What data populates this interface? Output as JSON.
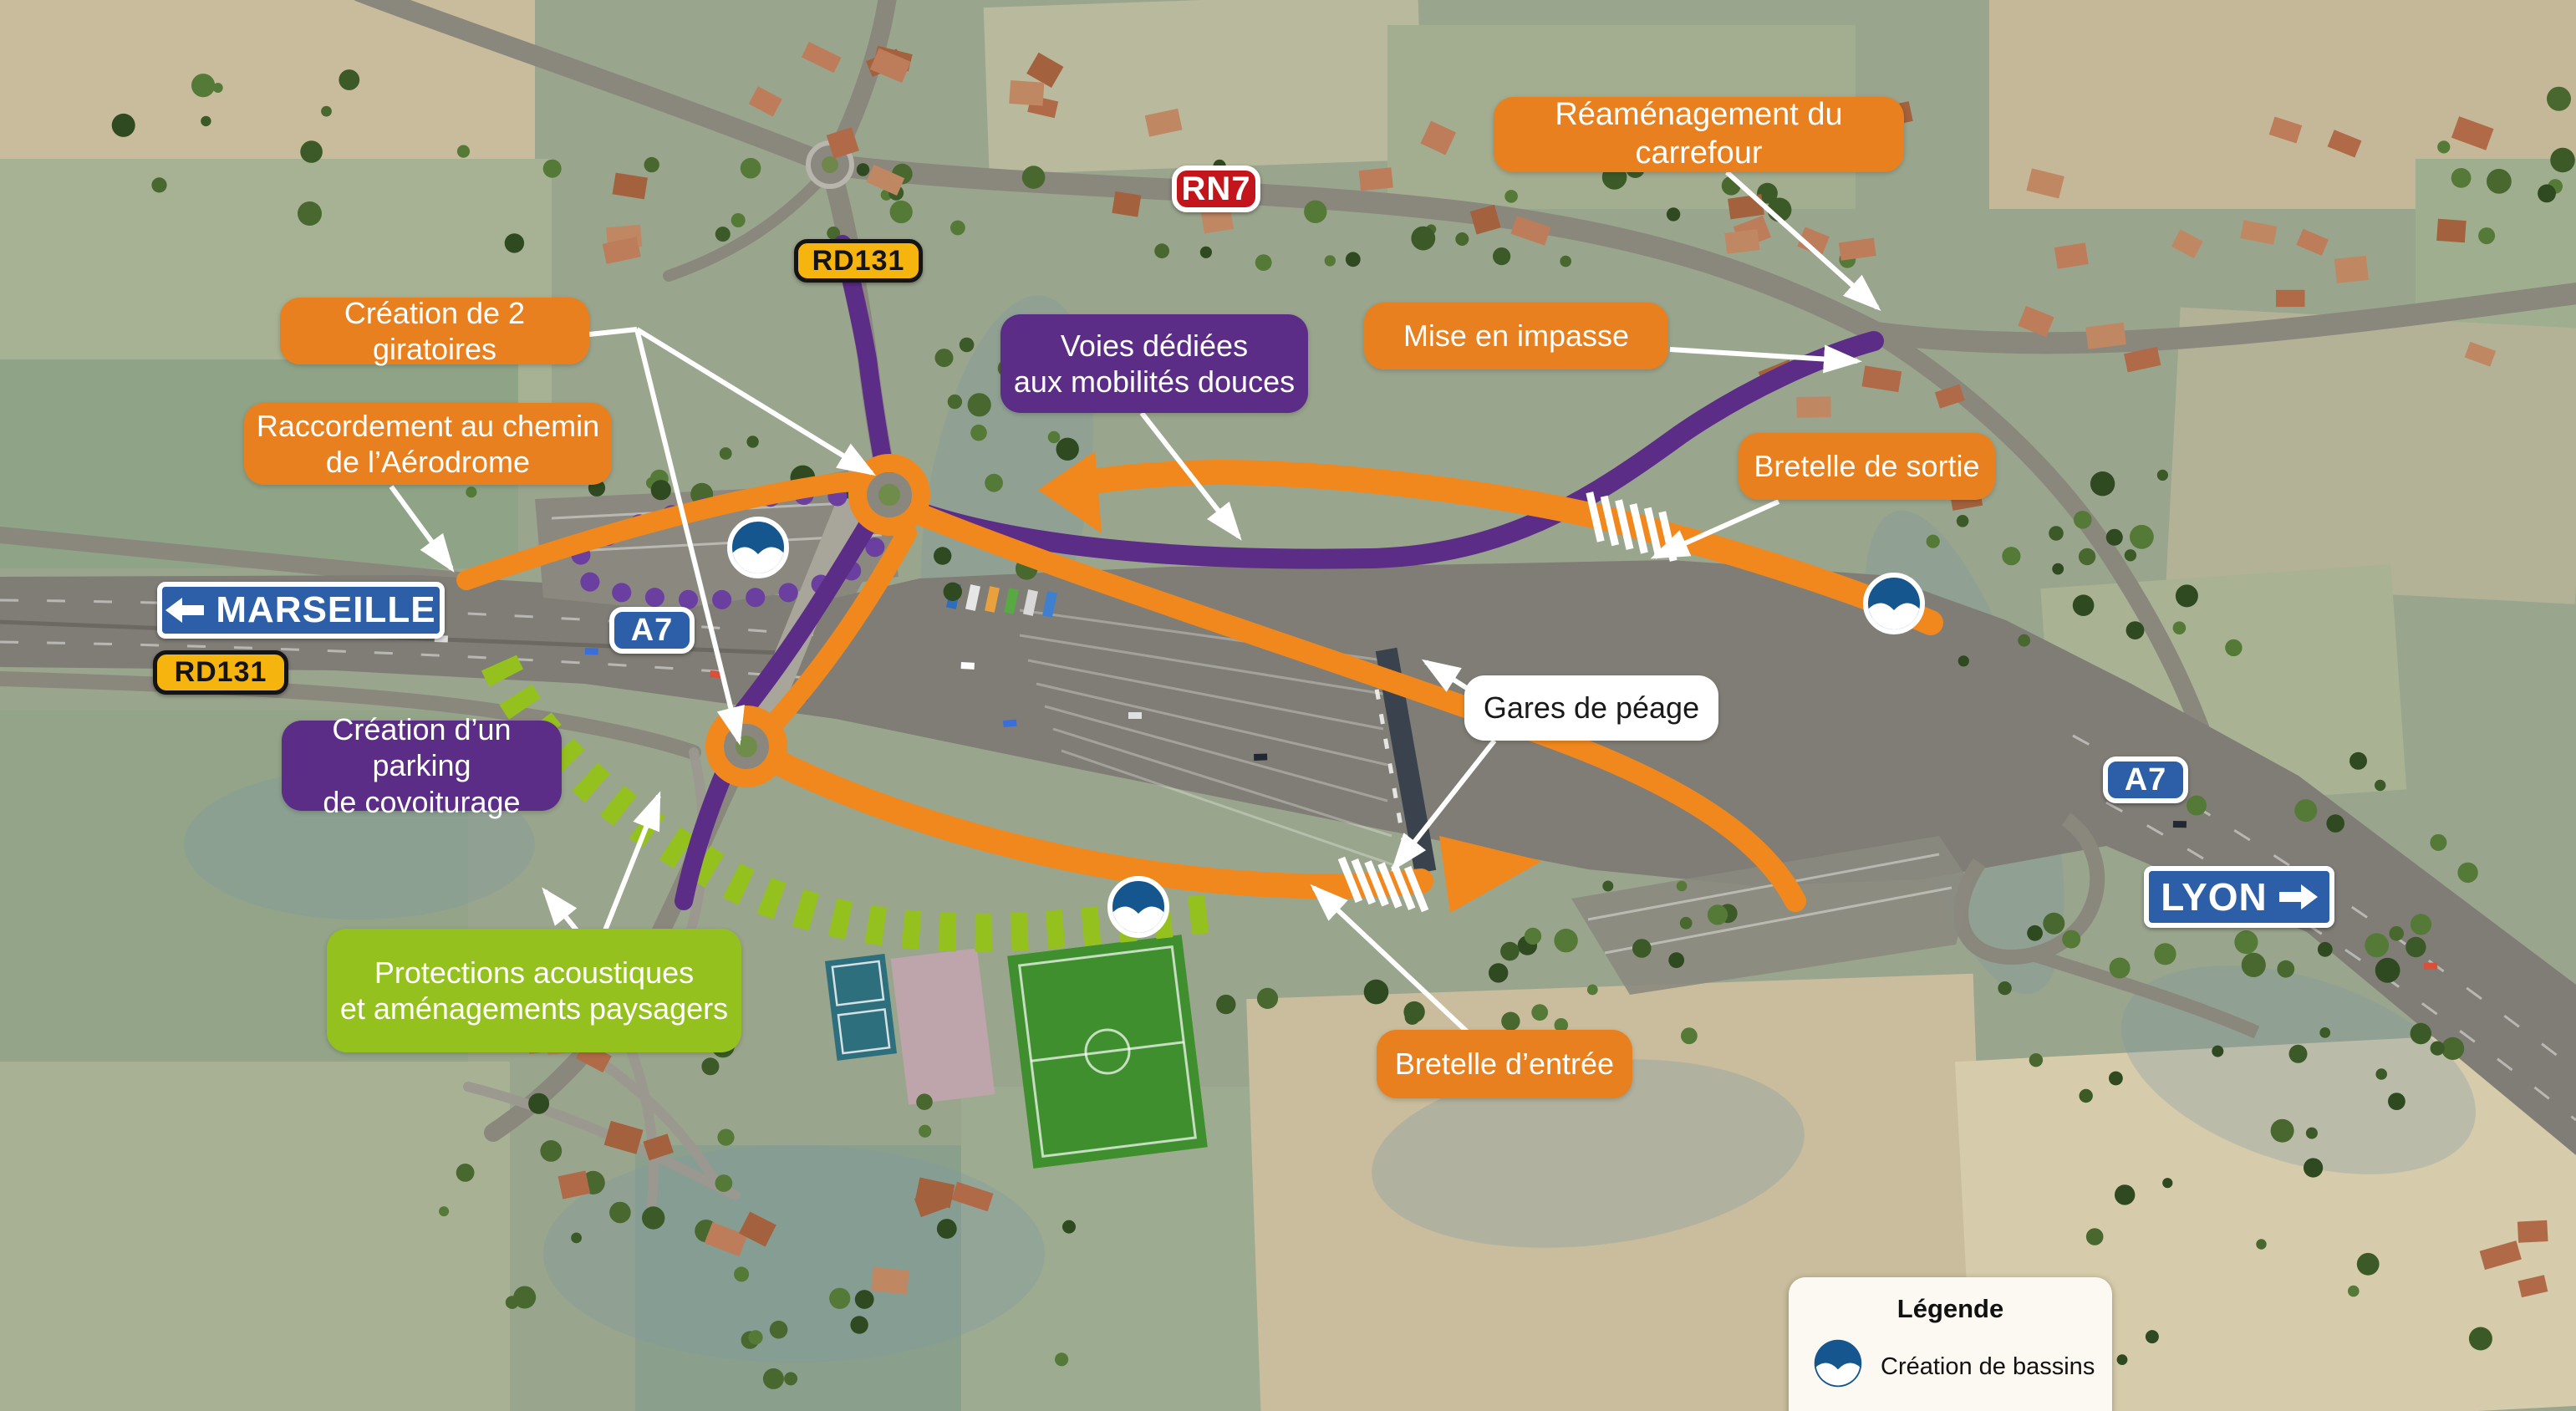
{
  "annotations": {
    "reamenagement": "Réaménagement du carrefour",
    "giratoires": "Création de 2 giratoires",
    "raccordement": "Raccordement au chemin\nde l’Aérodrome",
    "voies": "Voies dédiées\naux mobilités douces",
    "impasse": "Mise en impasse",
    "sortie": "Bretelle de sortie",
    "parking": "Création d’un parking\nde covoiturage",
    "gares": "Gares de péage",
    "protections": "Protections acoustiques\net aménagements paysagers",
    "entree": "Bretelle d’entrée"
  },
  "road_signs": {
    "marseille": "MARSEILLE",
    "lyon": "LYON",
    "a7_left": "A7",
    "a7_right": "A7",
    "rn7": "RN7",
    "rd131_top": "RD131",
    "rd131_left": "RD131"
  },
  "legend": {
    "title": "Légende",
    "items": [
      {
        "icon": "bassin-icon",
        "label": "Création de bassins"
      }
    ]
  },
  "colors": {
    "annotation_orange": "#E8801F",
    "annotation_purple": "#5B2D87",
    "annotation_green": "#95C11F",
    "route_orange": "#F0881E",
    "route_purple": "#5C2D87",
    "sign_blue": "#2C5FA8",
    "rn7_red": "#C3161C",
    "rd131_yellow": "#F6B40E",
    "bassin_blue": "#15568F"
  }
}
